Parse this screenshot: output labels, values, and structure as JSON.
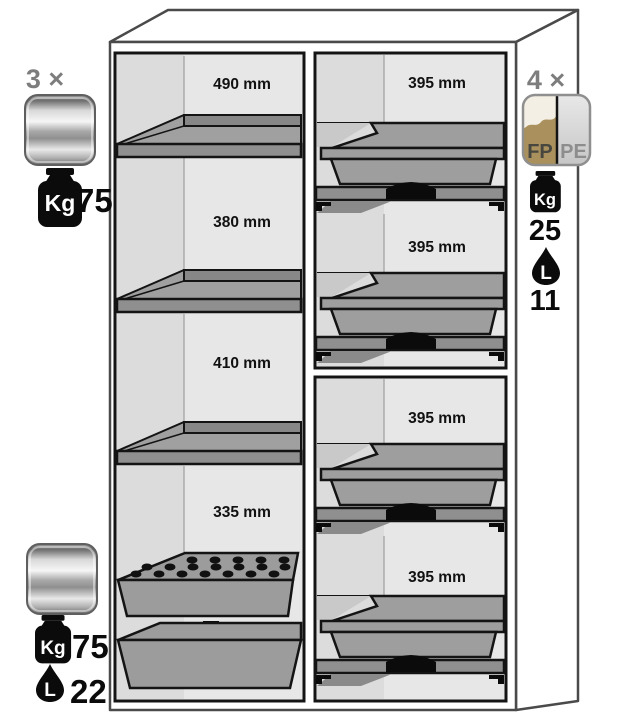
{
  "diagram": {
    "kind": "safety-cabinet-interior-equipment-diagram",
    "left_column_sections": [
      "490 mm",
      "380 mm",
      "410 mm",
      "335 mm"
    ],
    "right_column_sections": [
      "395 mm",
      "395 mm",
      "395 mm",
      "395 mm"
    ],
    "callouts": {
      "shelf": {
        "count": "3 ×",
        "weight_unit": "Kg",
        "weight": "75"
      },
      "tray": {
        "count": "4 ×",
        "material_left": "FP",
        "material_right": "PE",
        "weight_unit": "Kg",
        "weight": "25",
        "volume_unit": "L",
        "volume": "11"
      },
      "bottom": {
        "weight_unit": "Kg",
        "weight": "75",
        "volume_unit": "L",
        "volume": "22"
      }
    },
    "colors": {
      "interior_grey": "#e7e7e7",
      "steel_grey": "#9e9e9e",
      "outline_black": "#141414",
      "cabinet_line_grey": "#4a4a4a",
      "fp_gold": "#a9905c",
      "pe_silver": "#d9d9d9",
      "count_grey": "#7d7d7d"
    }
  }
}
